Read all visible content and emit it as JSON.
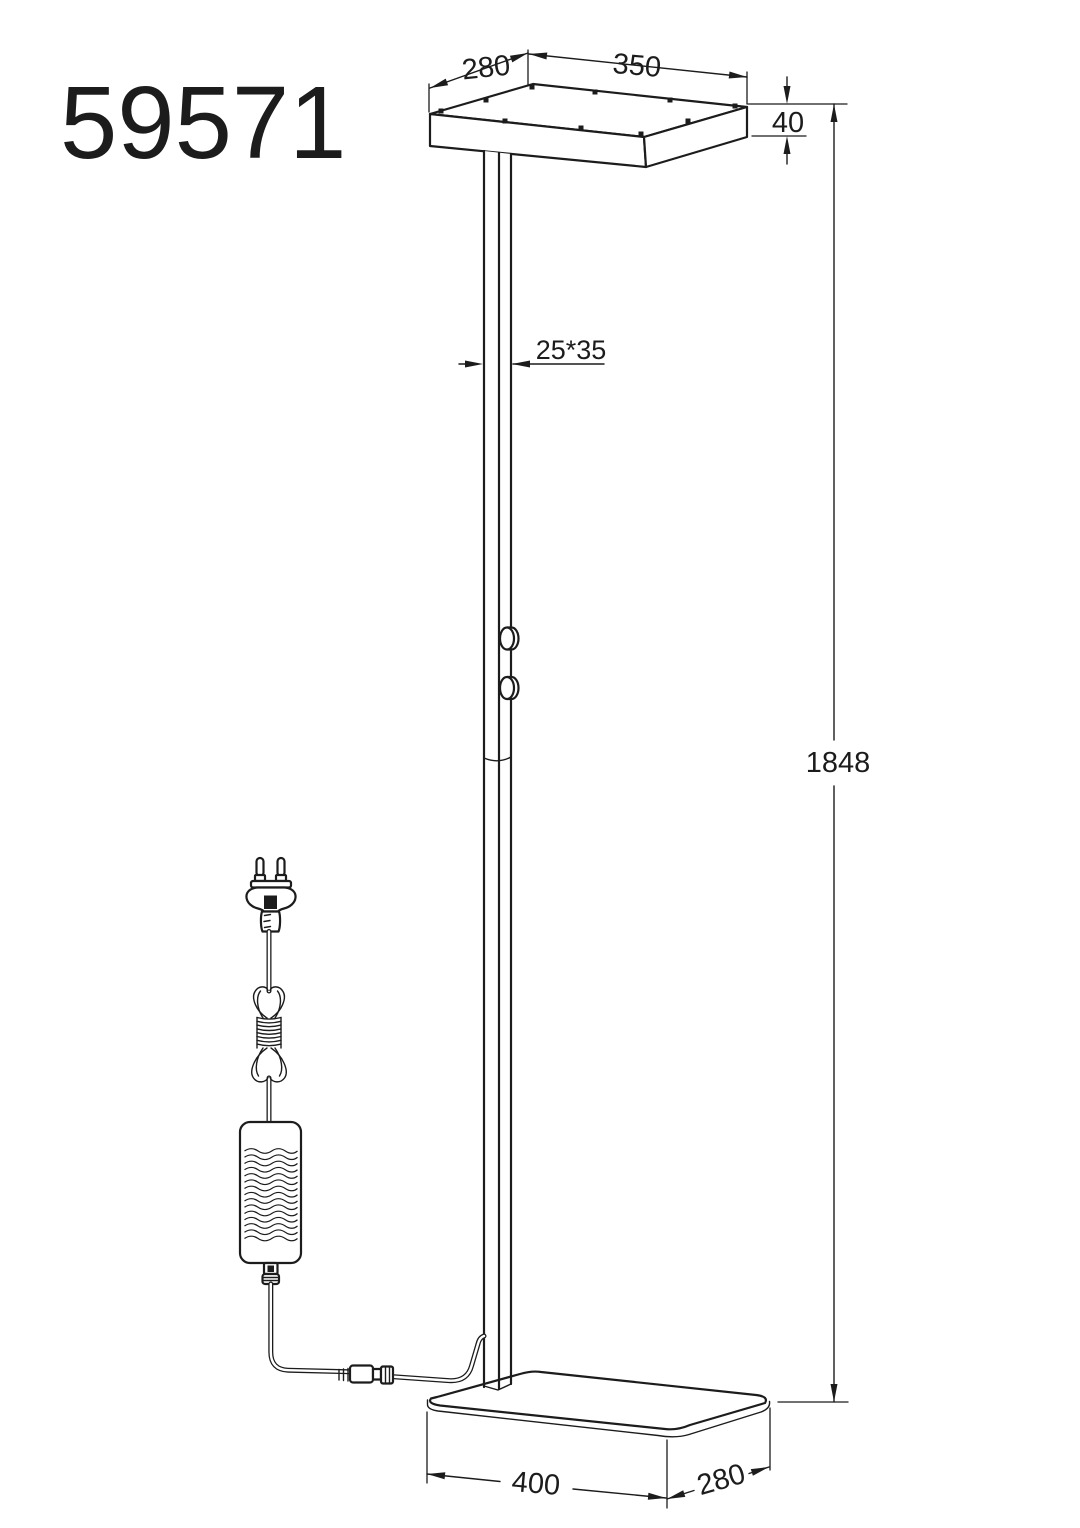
{
  "page": {
    "background": "#ffffff",
    "line_color": "#1c1c1c"
  },
  "title": {
    "model_number": "59571"
  },
  "dimensions": {
    "head_depth": "280",
    "head_width": "350",
    "head_height": "40",
    "pole_section": "25*35",
    "total_height": "1848",
    "base_width": "400",
    "base_depth": "280"
  }
}
